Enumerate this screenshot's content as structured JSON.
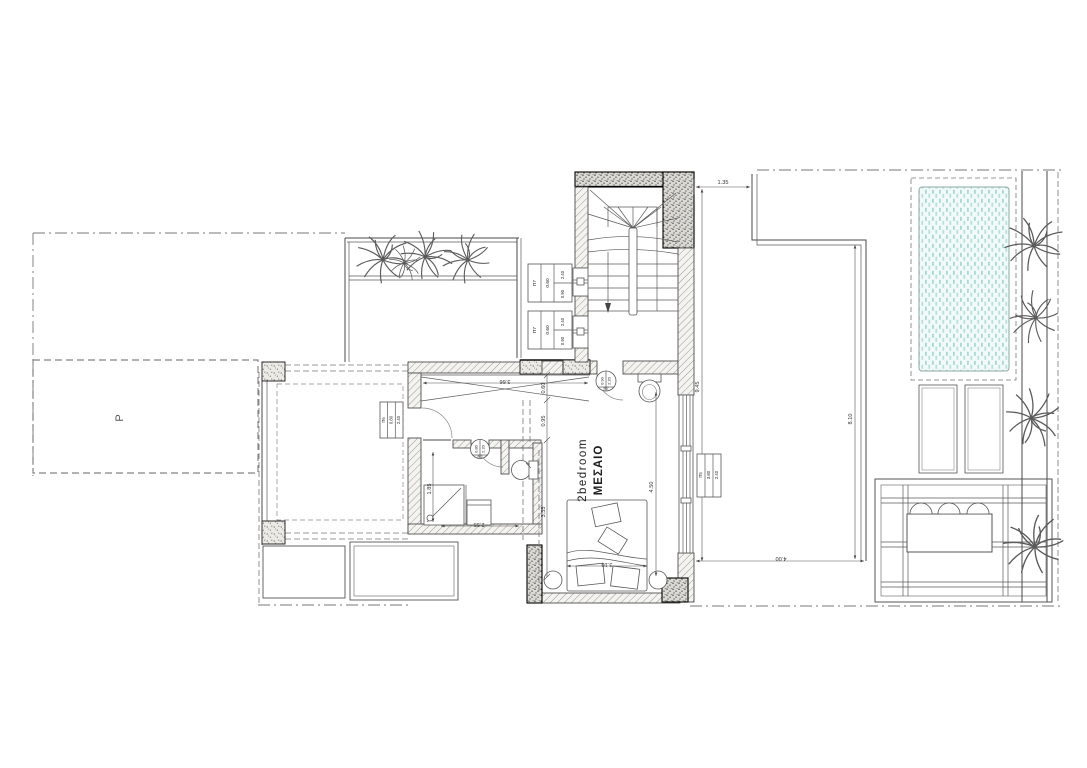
{
  "plan": {
    "parking_label": "P",
    "room": {
      "line1": "2bedroom",
      "line2": "ΜΕΣΑΙΟ"
    },
    "dims": {
      "top": "1.35",
      "right_wall": "9.45",
      "terrace_v": "8.10",
      "terrace_w": "4.00",
      "hall": "3.66",
      "chain1": "0.60",
      "chain2": "0.95",
      "chain3": "3.35",
      "bedroom_v": "4.50",
      "bed_w": "3.10",
      "bath_v": "1.85",
      "bath_w": "2.55"
    },
    "tags": {
      "p7a": {
        "code": "Π7",
        "sill": "0.60",
        "w": "0.90",
        "h": "2.40"
      },
      "p7b": {
        "code": "Π7",
        "sill": "0.60",
        "w": "0.90",
        "h": "2.40"
      },
      "p6": {
        "code": "Π6",
        "w": "0.80",
        "h": "2.40"
      },
      "p5": {
        "code": "Π5",
        "w": "3.80",
        "h": "2.40"
      },
      "m2": {
        "code": "Μ2",
        "w": "0.90",
        "h": "2.20"
      },
      "m3": {
        "code": "Μ3",
        "w": "0.80",
        "h": "2.20"
      }
    },
    "colors": {
      "pool_fill": "#f2faf9",
      "pool_dash": "#a7d8d3",
      "line": "#4a4a4a"
    }
  }
}
